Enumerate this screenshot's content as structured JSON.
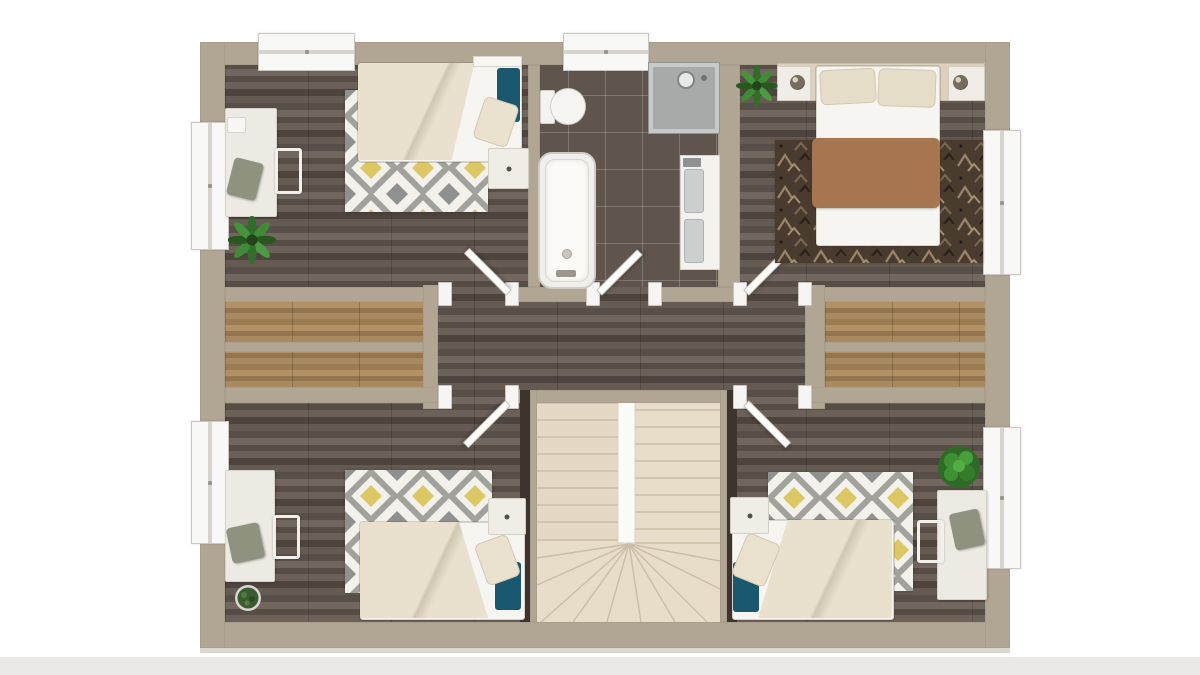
{
  "page": {
    "background": "#ffffff",
    "description": "3D rendered architectural floor plan, top-down view of an upper storey with four bedrooms, one bathroom, central landing and U-shaped staircase"
  },
  "palette": {
    "wall": "#b1a593",
    "floor_dark": "#61574f",
    "floor_light_wood": "#a08059",
    "bathroom_tile": "#5f554d",
    "stairs_cream": "#e8ddc9",
    "duvet_cream": "#e9e1ce",
    "accent_teal": "#19586f",
    "accent_yellow": "#ddc763",
    "rug_gray": "#8f9191",
    "master_blanket": "#a5764f",
    "master_rug_brown": "#4a3b2f",
    "furniture_cream": "#edeae3",
    "chair_olive": "#8e927f",
    "plant_green": "#35782e",
    "window_white": "#f8f8f6"
  },
  "plan": {
    "rooms": [
      {
        "id": "bedroom-top-left",
        "label": "Bedroom top-left",
        "furniture": [
          "single bed with cream duvet and teal pillow",
          "grey-yellow diamond rug",
          "desk against left wall",
          "desk chair",
          "nightstand",
          "floor plant",
          "wall shelf"
        ],
        "windows": 3,
        "doors": 1
      },
      {
        "id": "bathroom",
        "label": "Bathroom",
        "furniture": [
          "toilet",
          "bathtub",
          "corner shower",
          "vanity with two basins"
        ],
        "windows": 1,
        "doors": 1
      },
      {
        "id": "bedroom-top-right",
        "label": "Master bedroom top-right",
        "furniture": [
          "double bed with brown throw",
          "headboard panel with two nightstands and lamps",
          "dark patterned rug",
          "plant"
        ],
        "windows": 1,
        "doors": 1
      },
      {
        "id": "landing",
        "label": "Landing / hallway",
        "furniture": [
          "U-shaped staircase with centre void and winders",
          "built-in storage strips left",
          "built-in storage strips right"
        ],
        "windows": 0,
        "doors": 0
      },
      {
        "id": "bedroom-bottom-left",
        "label": "Bedroom bottom-left",
        "furniture": [
          "single bed with cream duvet and teal pillow",
          "grey-yellow diamond rug",
          "desk against left wall",
          "desk chair",
          "nightstand",
          "potted plant"
        ],
        "windows": 1,
        "doors": 1
      },
      {
        "id": "bedroom-bottom-right",
        "label": "Bedroom bottom-right",
        "furniture": [
          "single bed with cream duvet and teal pillow",
          "grey-yellow diamond rug",
          "desk against right wall",
          "desk chair",
          "nightstand",
          "bush plant"
        ],
        "windows": 1,
        "doors": 1
      }
    ],
    "totals": {
      "bedrooms": 4,
      "bathrooms": 1,
      "windows": 6,
      "interior_doors": 5,
      "staircases": 1
    }
  }
}
